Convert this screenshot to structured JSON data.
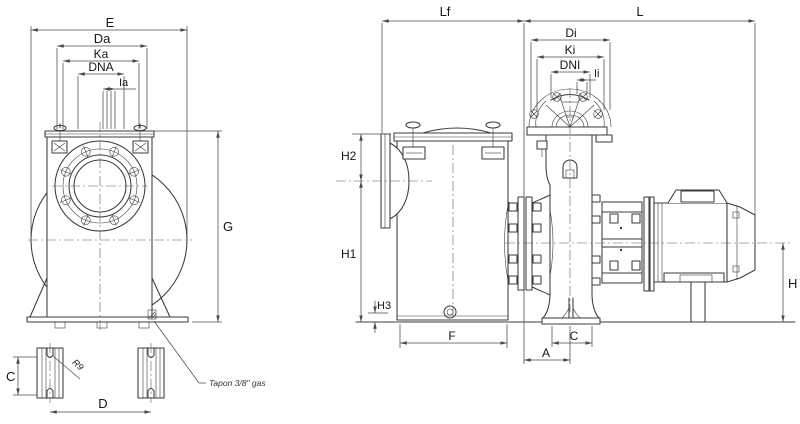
{
  "drawing": {
    "left_view": {
      "e": "E",
      "da": "Da",
      "ka": "Ka",
      "dna": "DNA",
      "ia": "Ia",
      "g": "G",
      "c": "C",
      "d": "D",
      "r9": "R9",
      "drain_note": "Tapon 3/8\" gas"
    },
    "side_view": {
      "lf": "Lf",
      "l": "L",
      "di": "Di",
      "ki": "Ki",
      "dni": "DNI",
      "ii": "Ii",
      "h2": "H2",
      "h1": "H1",
      "h3": "H3",
      "f": "F",
      "a": "A",
      "c": "C",
      "h": "H"
    },
    "colors": {
      "line": "#3b3b3b",
      "background": "#ffffff"
    }
  }
}
